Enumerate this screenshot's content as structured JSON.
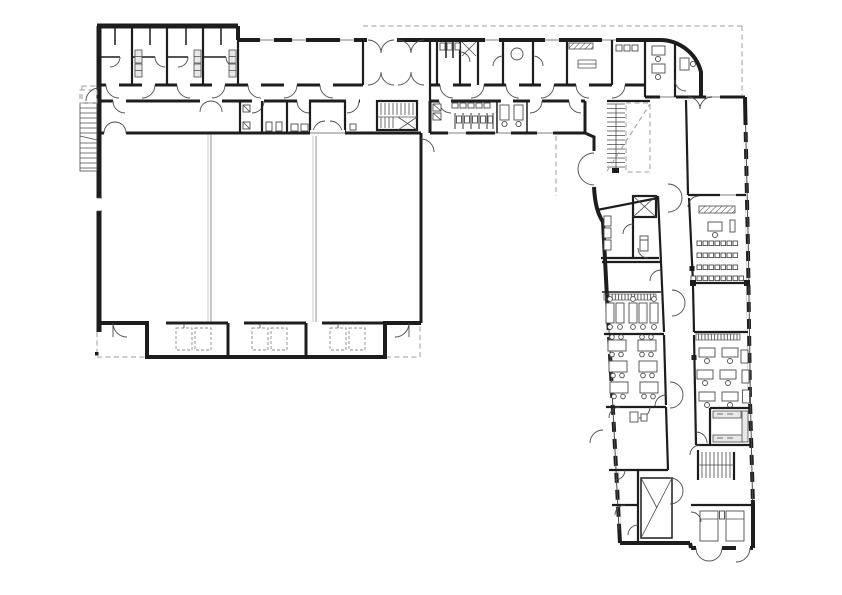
{
  "plan": {
    "description": "Ground floor plan of an L-shaped school building: triple sports hall with equipment storage bays, changing-room wing along the north side, entrance vestibule, sanitary block, main stairwell with elevator, and a slightly slanted south-east classroom wing with lecture room, classrooms, computer room and external stairs",
    "rooms": [
      "sports-hall",
      "equipment-storage-bays",
      "changing-rooms",
      "sanitary-block",
      "offices",
      "entrance-vestibule",
      "corridor",
      "main-stairwell",
      "elevator",
      "lecture-room",
      "classroom",
      "computer-room",
      "kitchenette",
      "rest-room"
    ],
    "hall_courts": 3,
    "site_boundary": "dashed"
  },
  "colors": {
    "paper": "#ffffff",
    "ink": "#1d1d1d",
    "mid": "#4b4b4b",
    "light": "#9c9c9c",
    "win": "#c0c0c0",
    "equip": "#8a8a8a"
  }
}
